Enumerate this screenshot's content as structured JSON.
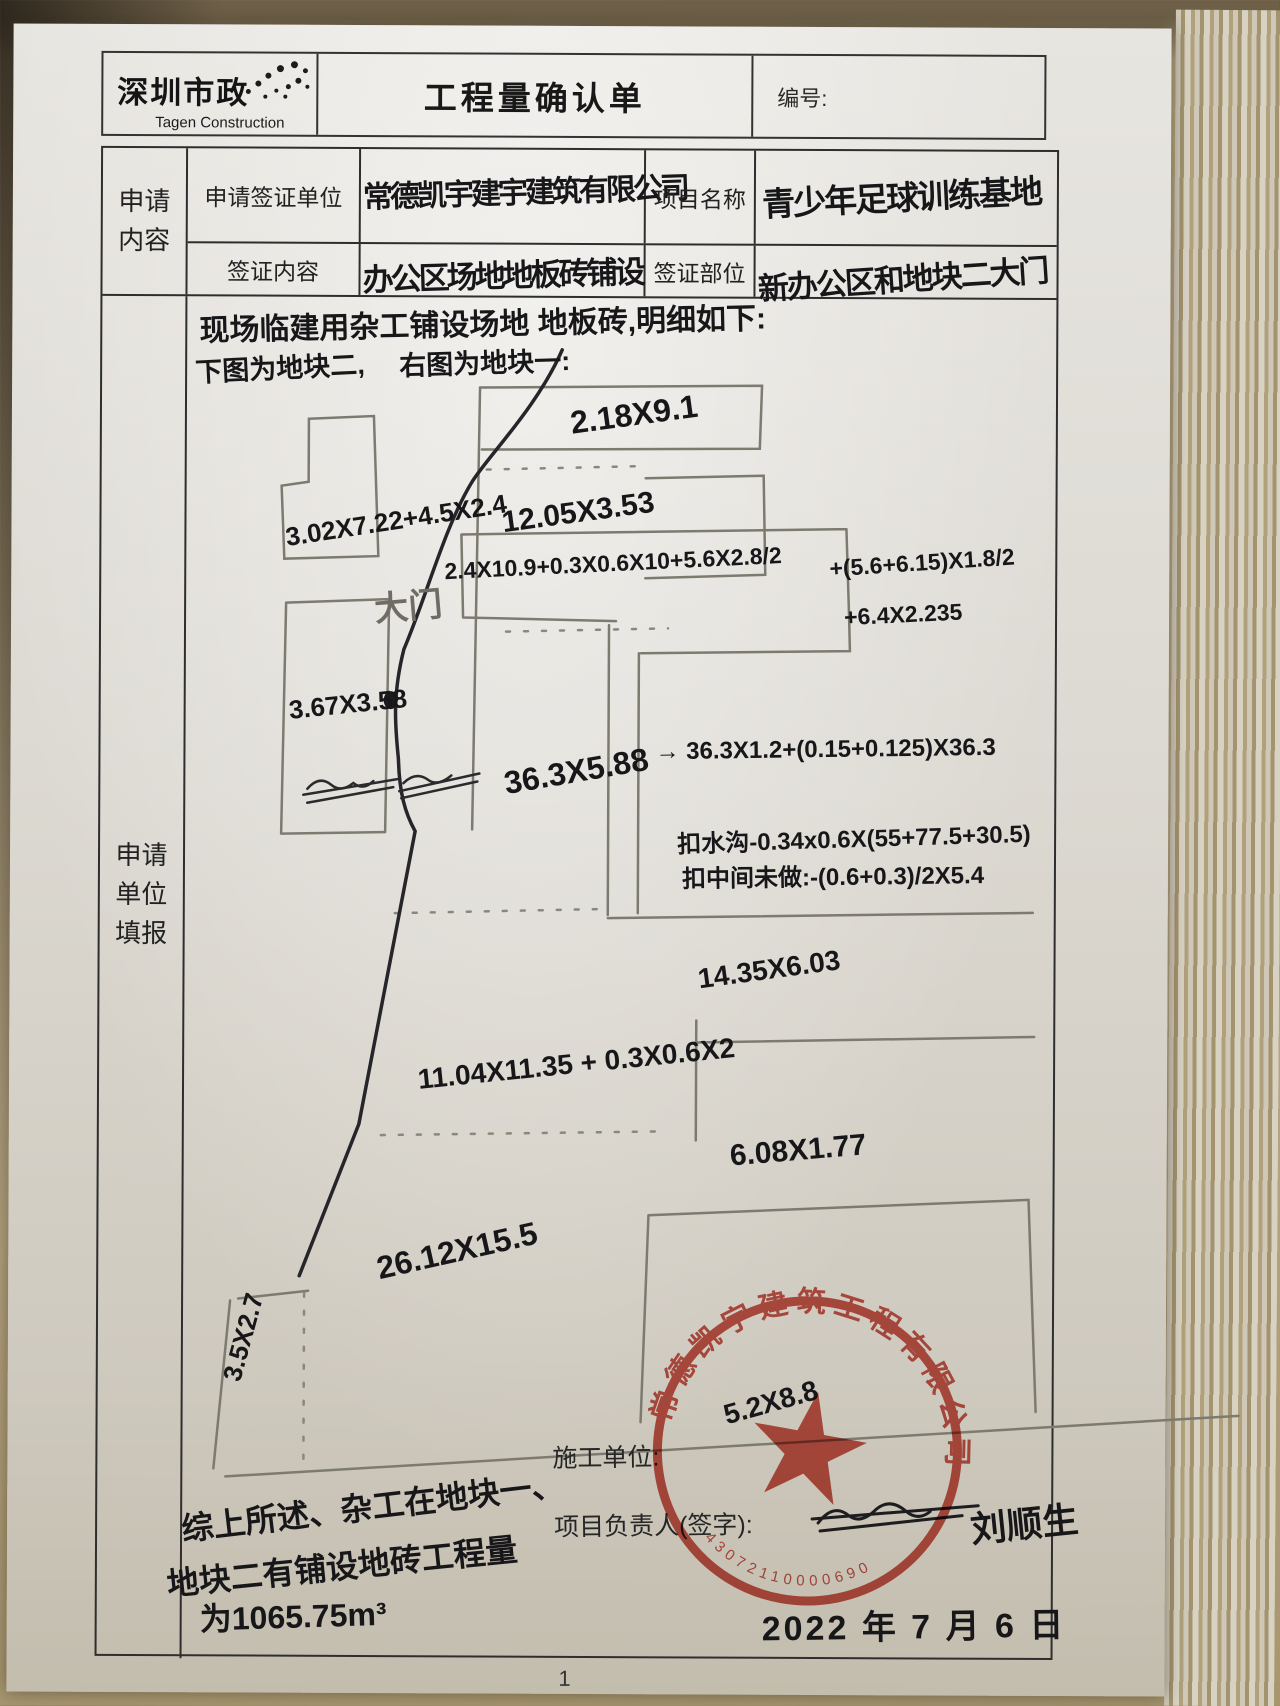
{
  "page": {
    "number": "1"
  },
  "header": {
    "logo_cn": "深圳市政",
    "logo_en": "Tagen Construction",
    "title": "工程量确认单",
    "doc_no_label": "编号:"
  },
  "form": {
    "section1_label": "申请内容",
    "section2_label": "申请单位填报",
    "rows": [
      {
        "label": "申请签证单位",
        "value": "常德凯宇建宇建筑有限公司",
        "label2": "项目名称",
        "value2": "青少年足球训练基地"
      },
      {
        "label": "签证内容",
        "value": "办公区场地地板砖铺设",
        "label2": "签证部位",
        "value2": "新办公区和地块二大门"
      }
    ]
  },
  "main": {
    "intro": "现场临建用杂工铺设场地 地板砖,明细如下:",
    "captions": {
      "left": "下图为地块二,",
      "right": "右图为地块一:"
    },
    "annotations": {
      "dim_top_bar": "2.18X9.1",
      "dim_second_bar": "12.05X3.53",
      "dim_block2_lshape": "3.02X7.22+4.5X2.4",
      "gate_label": "大门",
      "dim_block2_rect": "3.67X3.58",
      "formula_main": "2.4X10.9+0.3X0.6X10+5.6X2.8/2",
      "formula_add1": "+(5.6+6.15)X1.8/2",
      "formula_add2": "+6.4X2.235",
      "dim_strip": "36.3X5.88",
      "formula_strip": "→ 36.3X1.2+(0.15+0.125)X36.3",
      "deduct_gutter": "扣水沟-0.34x0.6X(55+77.5+30.5)",
      "deduct_middle": "扣中间未做:-(0.6+0.3)/2X5.4",
      "dim_mid_bar": "14.35X6.03",
      "formula_lower": "11.04X11.35 + 0.3X0.6X2",
      "dim_lower_bar": "6.08X1.77",
      "dim_big_area": "26.12X15.5",
      "dim_small_plot": "3.5X2.7",
      "dim_stamp_area": "5.2X8.8"
    },
    "summary": {
      "line1": "综上所述、杂工在地块一、",
      "line2": "地块二有铺设地砖工程量",
      "line3": "为1065.75m³"
    },
    "footer": {
      "builder_label": "施工单位:",
      "manager_label": "项目负责人(签字):",
      "signature": "刘顺生",
      "date": "2022 年 7 月 6 日"
    },
    "stamp": {
      "company": "常德凯宇建筑工程有限公司",
      "number": "43072110000690"
    }
  }
}
